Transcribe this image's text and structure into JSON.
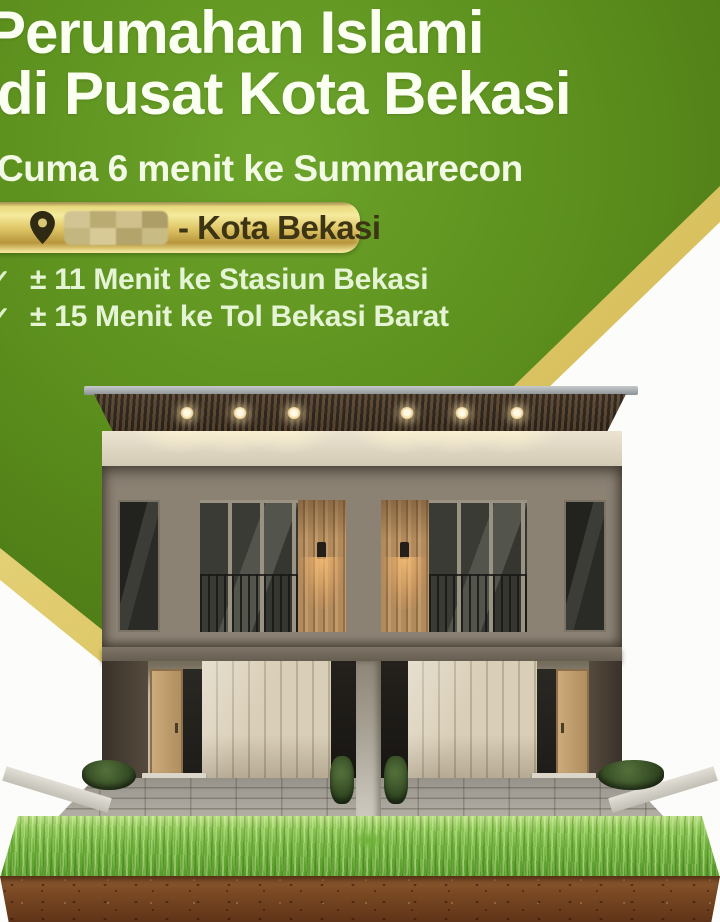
{
  "poster": {
    "headline": {
      "line1": "Perumahan Islami",
      "line2": "di Pusat Kota Bekasi"
    },
    "subheadline": "Cuma 6 menit ke Summarecon",
    "location_badge": {
      "icon": "location-pin",
      "text": "- Kota Bekasi",
      "note": "location name pixel-blurred"
    },
    "benefits": {
      "check_glyph": "✓",
      "items": [
        {
          "text": "± 11 Menit ke Stasiun Bekasi"
        },
        {
          "text": "± 15 Menit ke Tol Bekasi Barat"
        }
      ]
    },
    "colors": {
      "green_background": "#5c8f1d",
      "green_dark_corner": "#466f12",
      "gold_stripe": "#e2cf6b",
      "badge_gold": "#e9d97e",
      "badge_text": "#3c3413",
      "headline_text": "#fbfff2",
      "benefit_text": "#e5f4d4",
      "grass": "#6fb23a",
      "soil": "#7b4a24",
      "house_facade": "#8b8274",
      "house_wood": "#b28a5c"
    },
    "illustration": "3D render of modern two-storey twin house on grass and soil cross-section"
  }
}
